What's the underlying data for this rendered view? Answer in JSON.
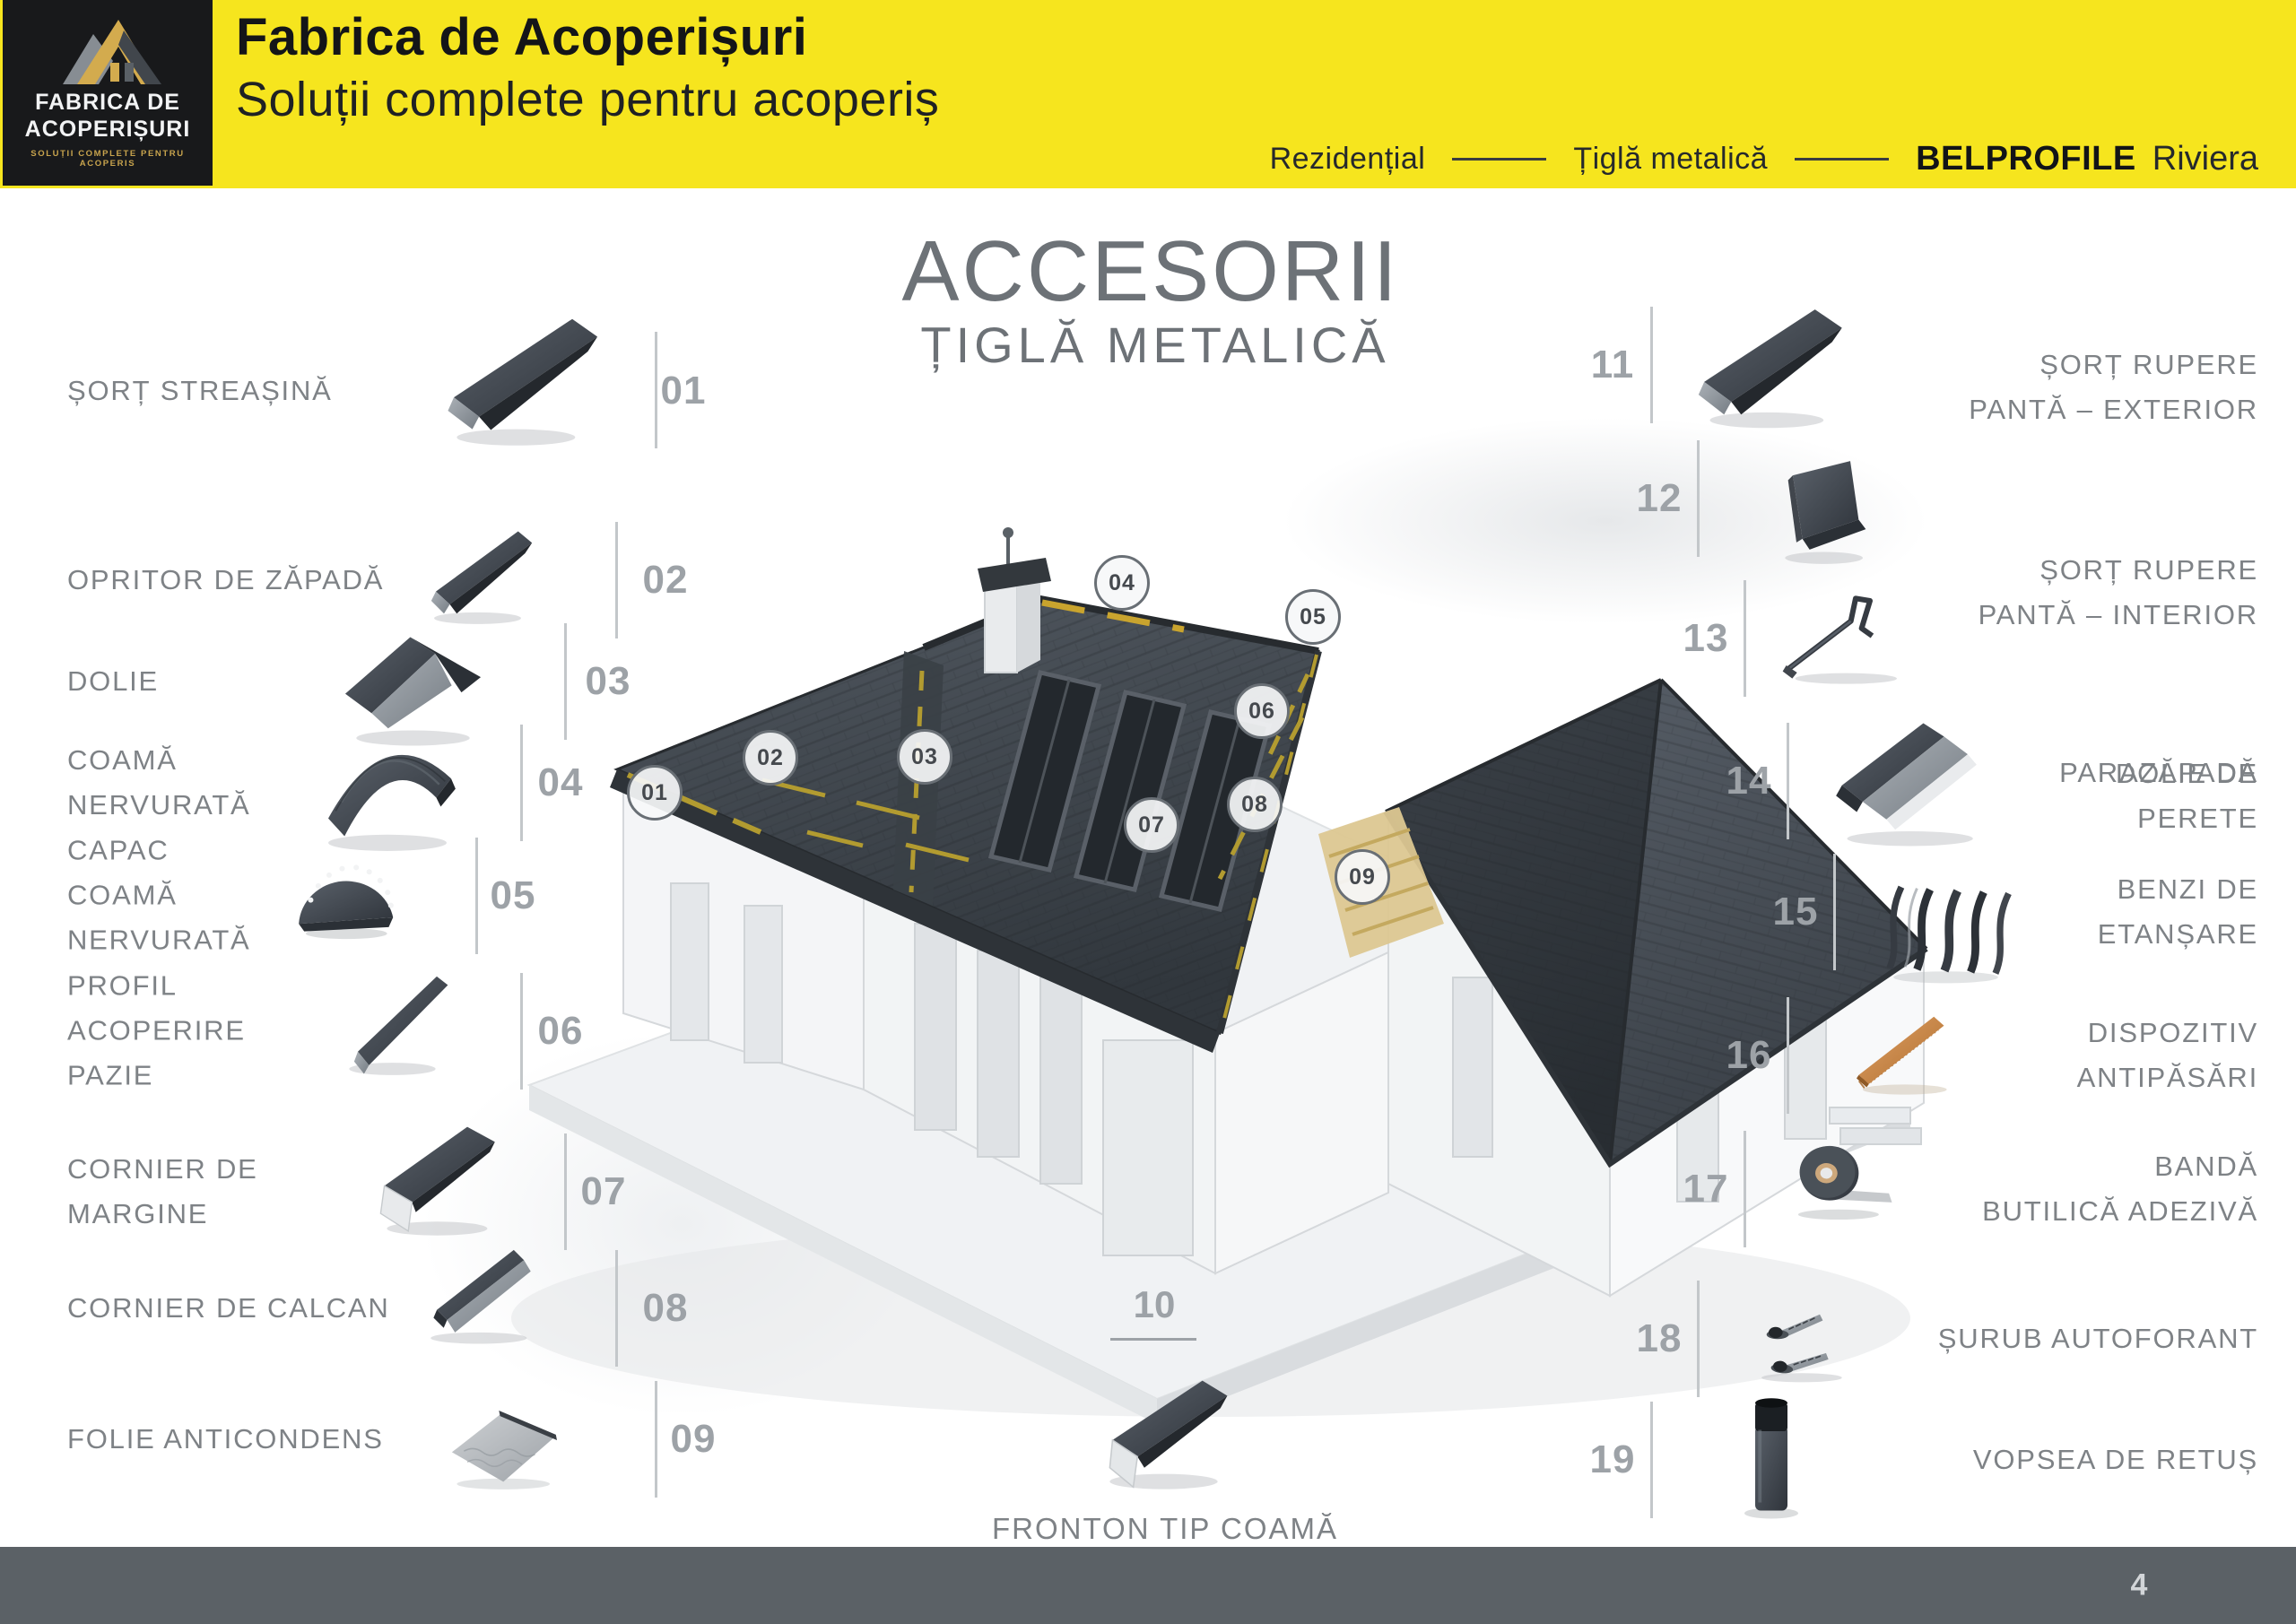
{
  "header": {
    "logo": {
      "icon": "roof-logo-icon",
      "line1": "FABRICA DE",
      "line2": "ACOPERIȘURI",
      "tagline": "SOLUȚII COMPLETE PENTRU ACOPERIS"
    },
    "title": "Fabrica de Acoperișuri",
    "subtitle": "Soluții complete pentru acoperiș",
    "breadcrumb": {
      "category": "Rezidențial",
      "product_type": "Țiglă metalică",
      "brand": "BELPROFILE",
      "series": "Riviera"
    },
    "colors": {
      "background": "#F6E51E",
      "logo_bg": "#18191B",
      "logo_gold": "#C8A44D"
    }
  },
  "main": {
    "title": "ACCESORII",
    "subtitle": "ȚIGLĂ METALICĂ"
  },
  "items": {
    "left": [
      {
        "number": "01",
        "label": "ȘORȚ STREAȘINĂ"
      },
      {
        "number": "02",
        "label": "OPRITOR DE ZĂPADĂ"
      },
      {
        "number": "03",
        "label": "DOLIE"
      },
      {
        "number": "04",
        "label": "COAMĂ\nNERVURATĂ"
      },
      {
        "number": "05",
        "label": "CAPAC\nCOAMĂ\nNERVURATĂ"
      },
      {
        "number": "06",
        "label": "PROFIL\nACOPERIRE\nPAZIE"
      },
      {
        "number": "07",
        "label": "CORNIER DE\nMARGINE"
      },
      {
        "number": "08",
        "label": "CORNIER DE CALCAN"
      },
      {
        "number": "09",
        "label": "FOLIE ANTICONDENS"
      }
    ],
    "bottom": {
      "number": "10",
      "label": "FRONTON TIP COAMĂ"
    },
    "right": [
      {
        "number": "11",
        "label": "ȘORȚ RUPERE\nPANTĂ – EXTERIOR"
      },
      {
        "number": "12",
        "label": "ȘORȚ RUPERE\nPANTĂ – INTERIOR"
      },
      {
        "number": "13",
        "label": "PARAZĂPADĂ"
      },
      {
        "number": "14",
        "label": "DOLIE DE\nPERETE"
      },
      {
        "number": "15",
        "label": "BENZI DE\nETANȘARE"
      },
      {
        "number": "16",
        "label": "DISPOZITIV\nANTIPĂSĂRI"
      },
      {
        "number": "17",
        "label": "BANDĂ\nBUTILICĂ ADEZIVĂ"
      },
      {
        "number": "18",
        "label": "ȘURUB AUTOFORANT"
      },
      {
        "number": "19",
        "label": "VOPSEA DE RETUȘ"
      }
    ]
  },
  "callouts": [
    "01",
    "02",
    "03",
    "04",
    "05",
    "06",
    "07",
    "08",
    "09"
  ],
  "footer": {
    "page_number": "4",
    "background": "#5B6166"
  }
}
